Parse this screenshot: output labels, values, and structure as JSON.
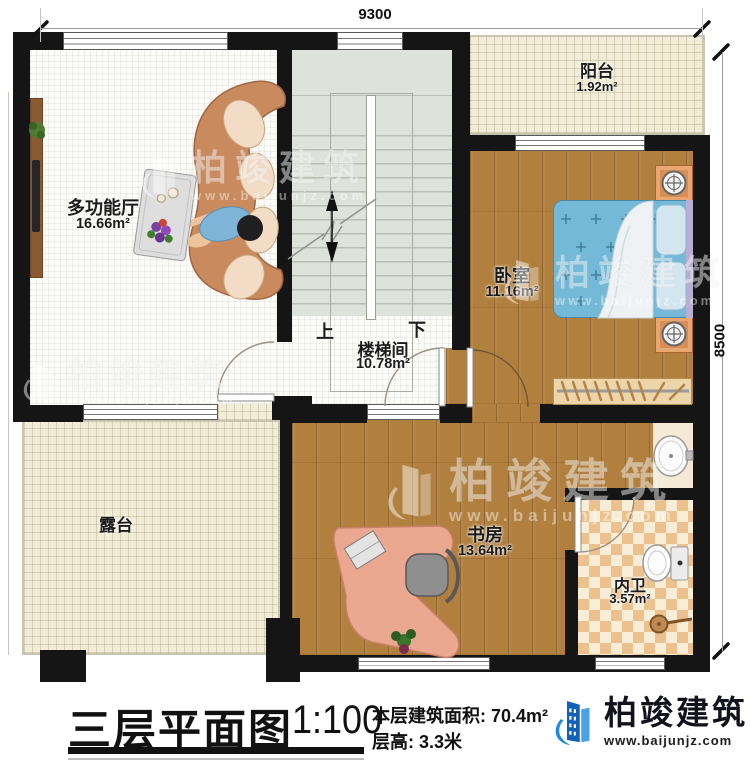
{
  "plan": {
    "dimensions": {
      "width_mm": "9300",
      "height_mm": "8500"
    },
    "rooms": {
      "hall": {
        "name": "多功能厅",
        "area": "16.66m²"
      },
      "stairwell": {
        "name": "楼梯间",
        "area": "10.78m²"
      },
      "bedroom": {
        "name": "卧室",
        "area": "11.16m²"
      },
      "balcony": {
        "name": "阳台",
        "area": "1.92m²"
      },
      "terrace": {
        "name": "露台"
      },
      "study": {
        "name": "书房",
        "area": "13.64m²"
      },
      "bathroom": {
        "name": "内卫",
        "area": "3.57m²"
      }
    },
    "stairs": {
      "up": "上",
      "down": "下"
    }
  },
  "titleblock": {
    "title": "三层平面图",
    "scale": "1:100",
    "floor_area_label": "本层建筑面积:",
    "floor_area_value": "70.4m²",
    "floor_height_label": "层高:",
    "floor_height_value": "3.3米"
  },
  "brand": {
    "name": "柏竣建筑",
    "website": "www.baijunjz.com"
  },
  "watermark": {
    "name": "柏竣建筑",
    "website": "www.baijunjz.com"
  },
  "colors": {
    "wall": "#151515",
    "wood": "#b1803f",
    "beige": "#f1ecd7",
    "stair": "#dde2da",
    "bed_blue": "#74bad8",
    "desk_salmon": "#eba890",
    "brand_blue": "#1565c0",
    "checker_tan": "#ecc18e"
  }
}
